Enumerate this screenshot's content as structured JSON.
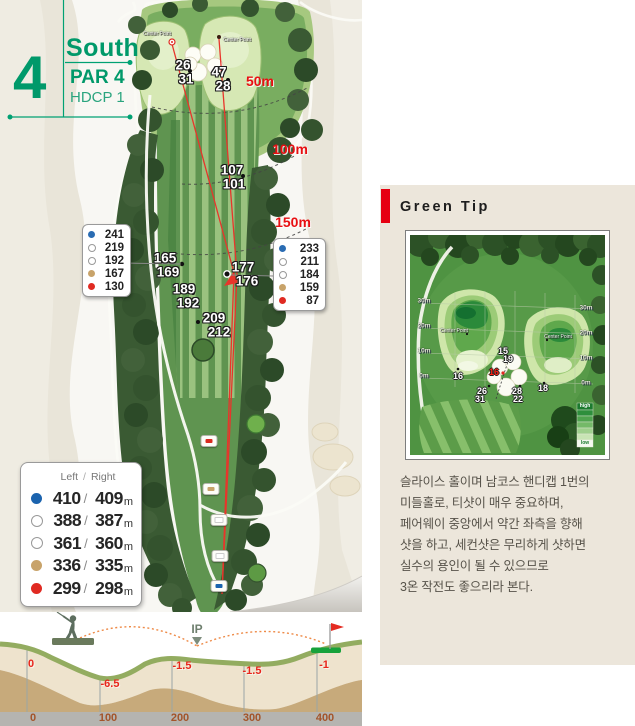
{
  "header": {
    "hole_number": "4",
    "course_name": "South",
    "par_label": "PAR 4",
    "hdcp_label": "HDCP 1"
  },
  "map": {
    "center_point_label": "Center Point",
    "distance_markers": {
      "m50": "50m",
      "m100": "100m",
      "m150": "150m"
    },
    "green_numbers": {
      "left_top": "26",
      "left_bottom": "31",
      "right_top": "47",
      "right_bottom": "28"
    },
    "fairway_points": [
      {
        "top": "107",
        "bottom": "101"
      },
      {
        "top": "165",
        "bottom": "169"
      },
      {
        "top": "177",
        "bottom": "176"
      },
      {
        "top": "189",
        "bottom": "192"
      },
      {
        "top": "209",
        "bottom": "212"
      }
    ],
    "legend_left": [
      "241",
      "219",
      "192",
      "167",
      "130"
    ],
    "legend_right": [
      "233",
      "211",
      "184",
      "159",
      "87"
    ],
    "tee_table": {
      "col_left": "Left",
      "col_sep": "/",
      "col_right": "Right",
      "unit": "m",
      "rows": [
        {
          "tee": "blue",
          "left": "410",
          "right": "409"
        },
        {
          "tee": "white",
          "left": "388",
          "right": "387"
        },
        {
          "tee": "white",
          "left": "361",
          "right": "360"
        },
        {
          "tee": "tan",
          "left": "336",
          "right": "335"
        },
        {
          "tee": "red",
          "left": "299",
          "right": "298"
        }
      ]
    }
  },
  "green_tip": {
    "title": "Green Tip",
    "center_point_label": "Center Point",
    "scale_left": [
      "30m",
      "20m",
      "10m",
      "0m"
    ],
    "scale_right": [
      "30m",
      "20m",
      "10m",
      "0m"
    ],
    "numbers": {
      "bunker_top": "15",
      "bunker_top2": "19",
      "bunker_center": "16",
      "bunker_left_top": "26",
      "bunker_left_bottom": "31",
      "bunker_right_top": "28",
      "bunker_right_bottom": "22",
      "left_green": "16",
      "right_green": "18"
    },
    "legend": {
      "high": "high",
      "low": "low"
    },
    "description_lines": [
      "슬라이스 홀이며 남코스 핸디캡 1번의",
      "미들홀로, 티샷이 매우 중요하며,",
      "페어웨이 중앙에서 약간 좌측을 향해",
      "샷을 하고, 세컨샷은 무리하게 샷하면",
      "실수의 용인이 될 수 있으므로",
      "3온 작전도 좋으리라 본다."
    ]
  },
  "elevation": {
    "ip_label": "IP",
    "points": [
      {
        "elev": "0",
        "dist": "0"
      },
      {
        "elev": "-6.5",
        "dist": "100"
      },
      {
        "elev": "-1.5",
        "dist": "200"
      },
      {
        "elev": "-1.5",
        "dist": "300"
      },
      {
        "elev": "-1",
        "dist": "400"
      }
    ]
  },
  "chart_data": {
    "type": "area",
    "title": "Hole 4 elevation profile",
    "x": [
      0,
      100,
      200,
      300,
      400
    ],
    "elevation": [
      0,
      -6.5,
      -1.5,
      -1.5,
      -1
    ],
    "xlabel": "distance (m)",
    "ylabel": "relative elevation (m)"
  }
}
